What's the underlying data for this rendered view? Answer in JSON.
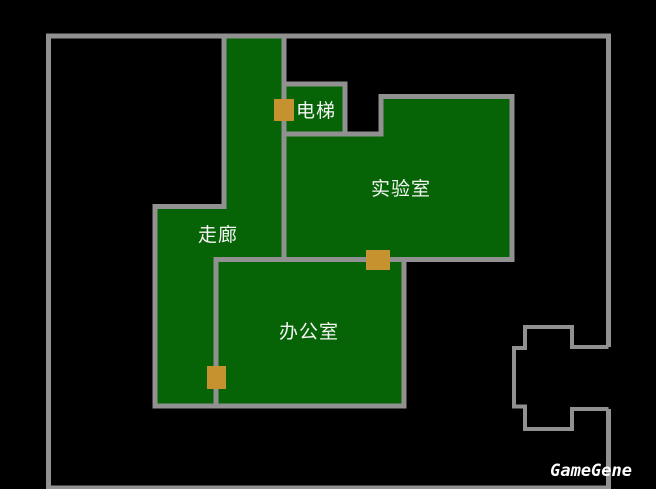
{
  "map": {
    "rooms": {
      "corridor": {
        "label": "走廊"
      },
      "elevator": {
        "label": "电梯"
      },
      "laboratory": {
        "label": "实验室"
      },
      "office": {
        "label": "办公室"
      }
    },
    "doors": [
      {
        "name": "elevator-door-marker"
      },
      {
        "name": "lab-office-door-marker"
      },
      {
        "name": "corridor-office-door-marker"
      }
    ]
  },
  "watermark": {
    "text": "GameGene"
  },
  "colors": {
    "background": "#000000",
    "room_fill": "#066306",
    "wall": "#919191",
    "door_fill": "#c6912f",
    "label_text": "#f5f5f5",
    "watermark_text": "#ffffff"
  }
}
